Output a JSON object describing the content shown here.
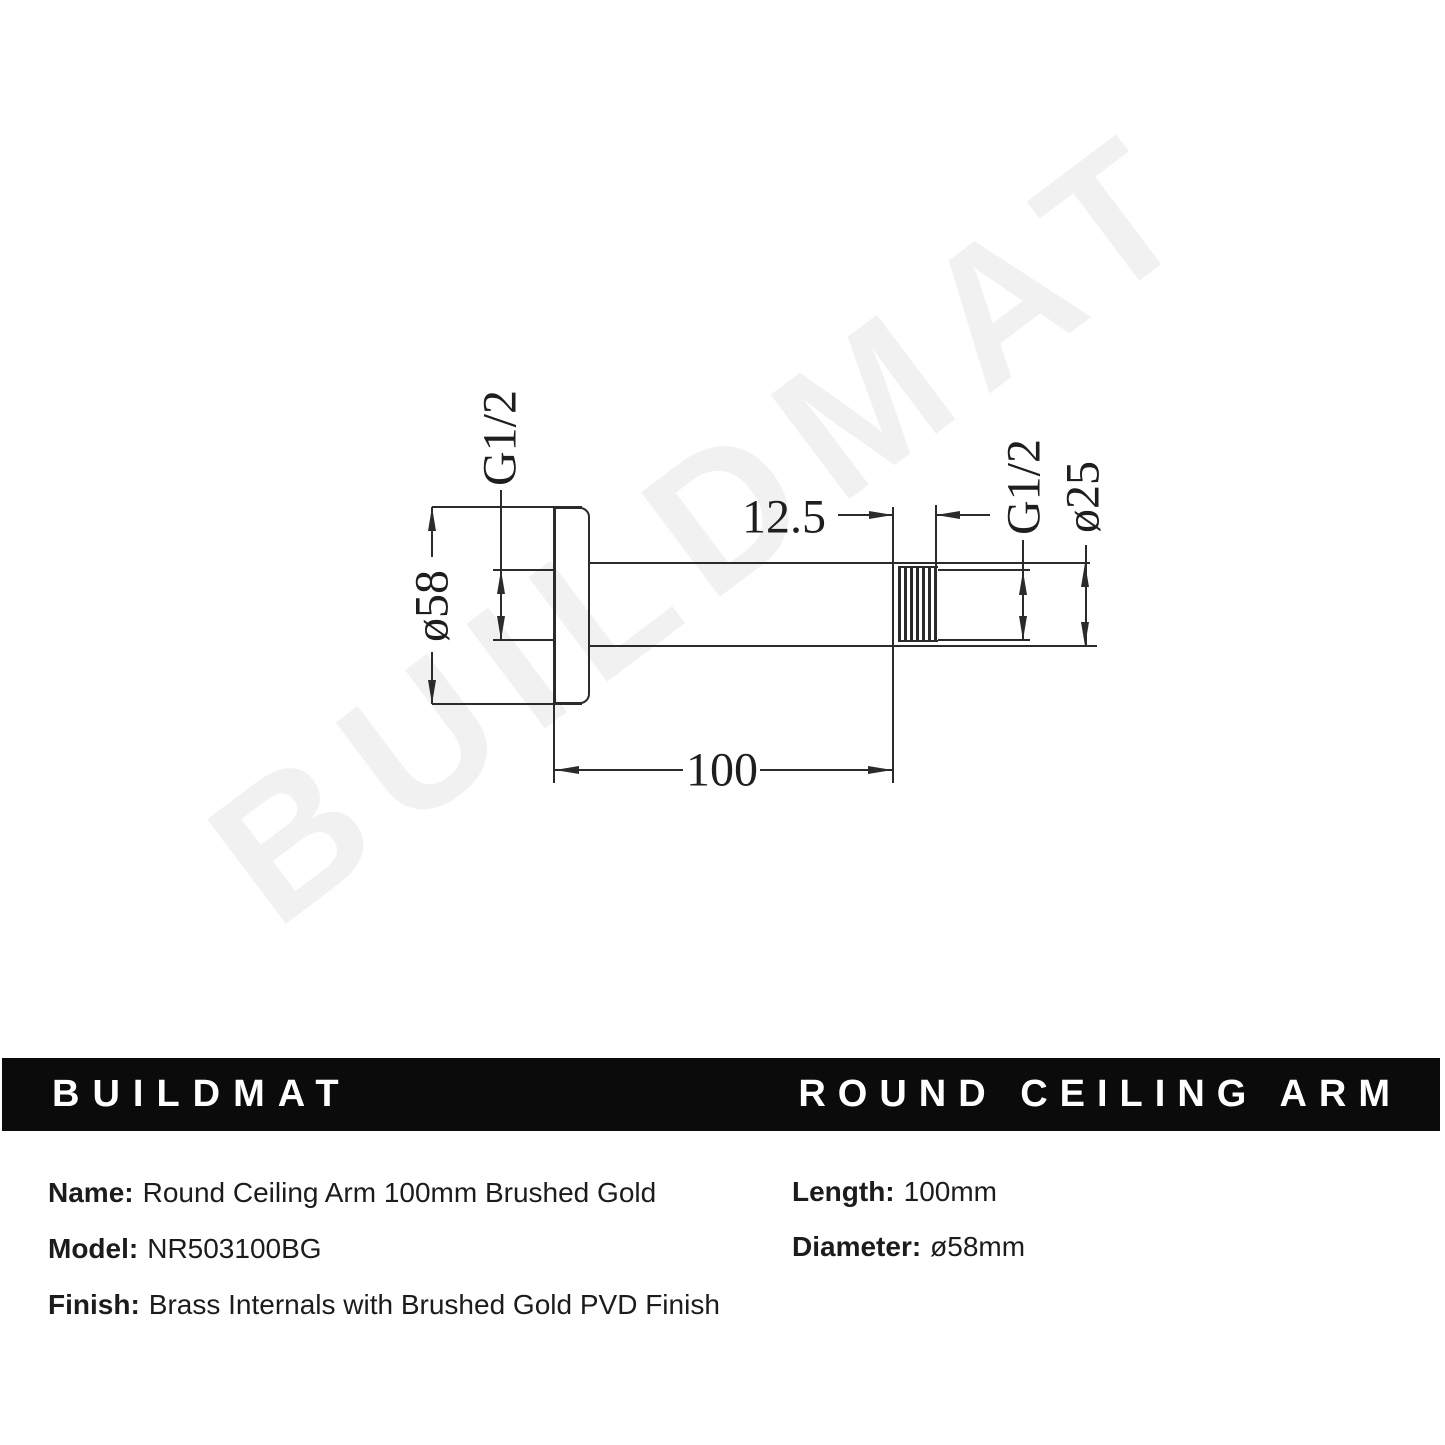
{
  "watermark": "BUILDMAT",
  "banner": {
    "brand": "BUILDMAT",
    "product": "ROUND CEILING ARM",
    "background": "#0b0b0b",
    "text_color": "#ffffff"
  },
  "drawing": {
    "line_color": "#2b2b2b",
    "labels": {
      "flange_thread": "G1/2",
      "flange_diameter": "ø58",
      "thread_length": "12.5",
      "outlet_thread": "G1/2",
      "arm_diameter": "ø25",
      "arm_length": "100"
    }
  },
  "specs": {
    "left": [
      {
        "label": "Name:",
        "value": "Round Ceiling Arm 100mm Brushed Gold"
      },
      {
        "label": "Model:",
        "value": "NR503100BG"
      },
      {
        "label": "Finish:",
        "value": "Brass Internals with Brushed Gold PVD Finish"
      }
    ],
    "right": [
      {
        "label": "Length:",
        "value": "100mm"
      },
      {
        "label": "Diameter:",
        "value": "ø58mm"
      }
    ]
  }
}
